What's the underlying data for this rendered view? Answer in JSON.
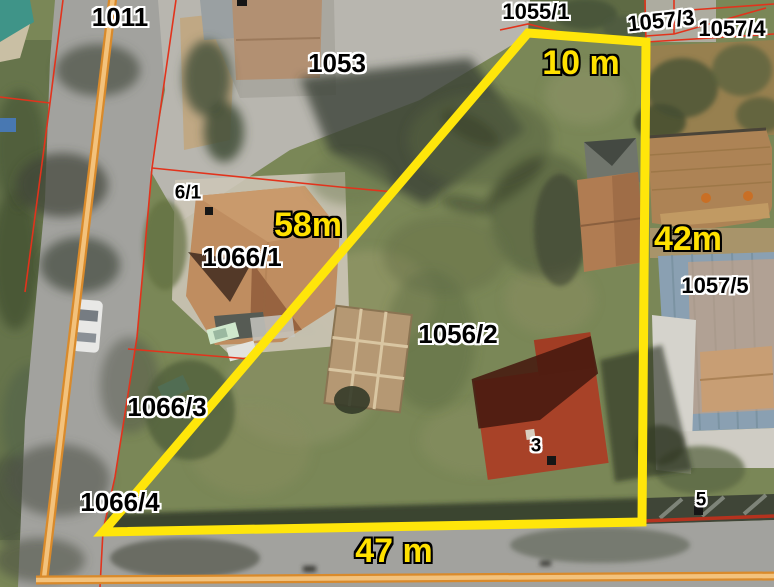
{
  "map_type": "cadastral-aerial-view",
  "parcel_labels": {
    "p1011": "1011",
    "p1053": "1053",
    "p1055_1": "1055/1",
    "p1057_3": "1057/3",
    "p1057_4": "1057/4",
    "p1057_5": "1057/5",
    "p1056_2": "1056/2",
    "p1066_1": "1066/1",
    "p1066_3": "1066/3",
    "p1066_4": "1066/4",
    "p6_1": "6/1",
    "house_3": "3",
    "house_5": "5"
  },
  "measurements": {
    "top_edge": "10 m",
    "right_edge": "42m",
    "left_edge": "58m",
    "bottom_edge": "47 m"
  },
  "highlighted_parcel": {
    "number": "1056/2",
    "side_lengths_m": {
      "top": 10,
      "right": 42,
      "left": 58,
      "bottom": 47
    }
  },
  "colors": {
    "parcel_outline": "#ffe60a",
    "cadastral_line": "#e2331c",
    "road_line": "#e89a3c",
    "dimension_text": "#ffe100",
    "label_text": "#000000",
    "label_halo": "#ffffff"
  }
}
